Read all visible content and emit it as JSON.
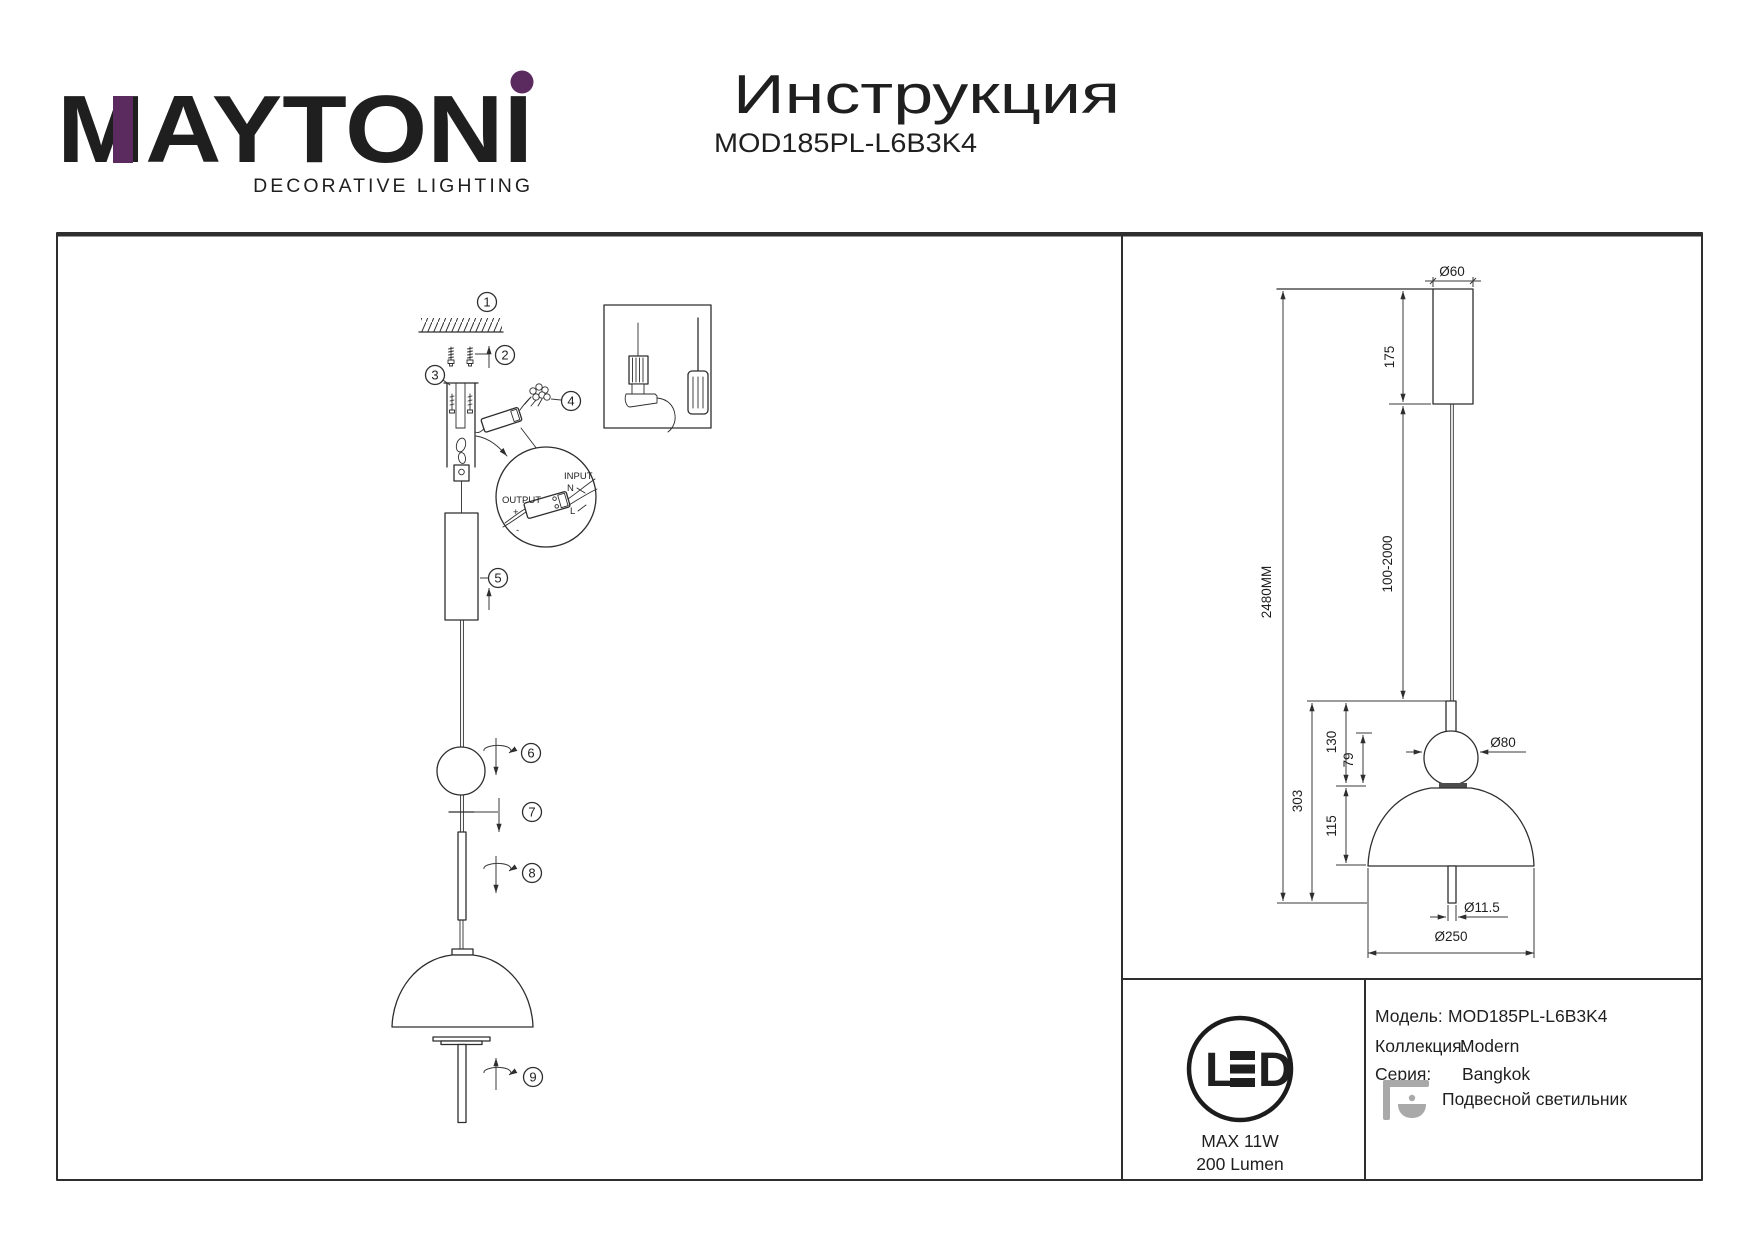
{
  "brand": {
    "logo": "MAYTONI",
    "tagline": "DECORATIVE LIGHTING"
  },
  "doc": {
    "title": "Инструкция",
    "model": "MOD185PL-L6B3K4"
  },
  "steps": [
    "1",
    "2",
    "3",
    "4",
    "5",
    "6",
    "7",
    "8",
    "9"
  ],
  "wiring": {
    "input": "INPUT",
    "input_n": "N",
    "input_l": "L",
    "output": "OUTPUT",
    "output_plus": "+",
    "output_minus": "-"
  },
  "dims": {
    "canopy_d": "Ø60",
    "canopy_h": "175",
    "cable": "100-2000",
    "total": "2480MM",
    "body": "303",
    "top_to_dome": "130",
    "sphere_gap": "79",
    "dome_h": "115",
    "sphere_d": "Ø80",
    "rod_d": "Ø11.5",
    "shade_d": "Ø250"
  },
  "spec": {
    "led_l": "L",
    "led_d": "D",
    "max_power": "MAX 11W",
    "luminous": "200 Lumen",
    "model_label": "Модель:",
    "model": "MOD185PL-L6B3K4",
    "collection_label": "Коллекция:",
    "collection": "Modern",
    "series_label": "Серия:",
    "series": "Bangkok",
    "type": "Подвесной светильник"
  },
  "colors": {
    "brand_purple": "#5b2a5e",
    "line": "#2e2e2e",
    "icon_gray": "#a9a9a9"
  }
}
